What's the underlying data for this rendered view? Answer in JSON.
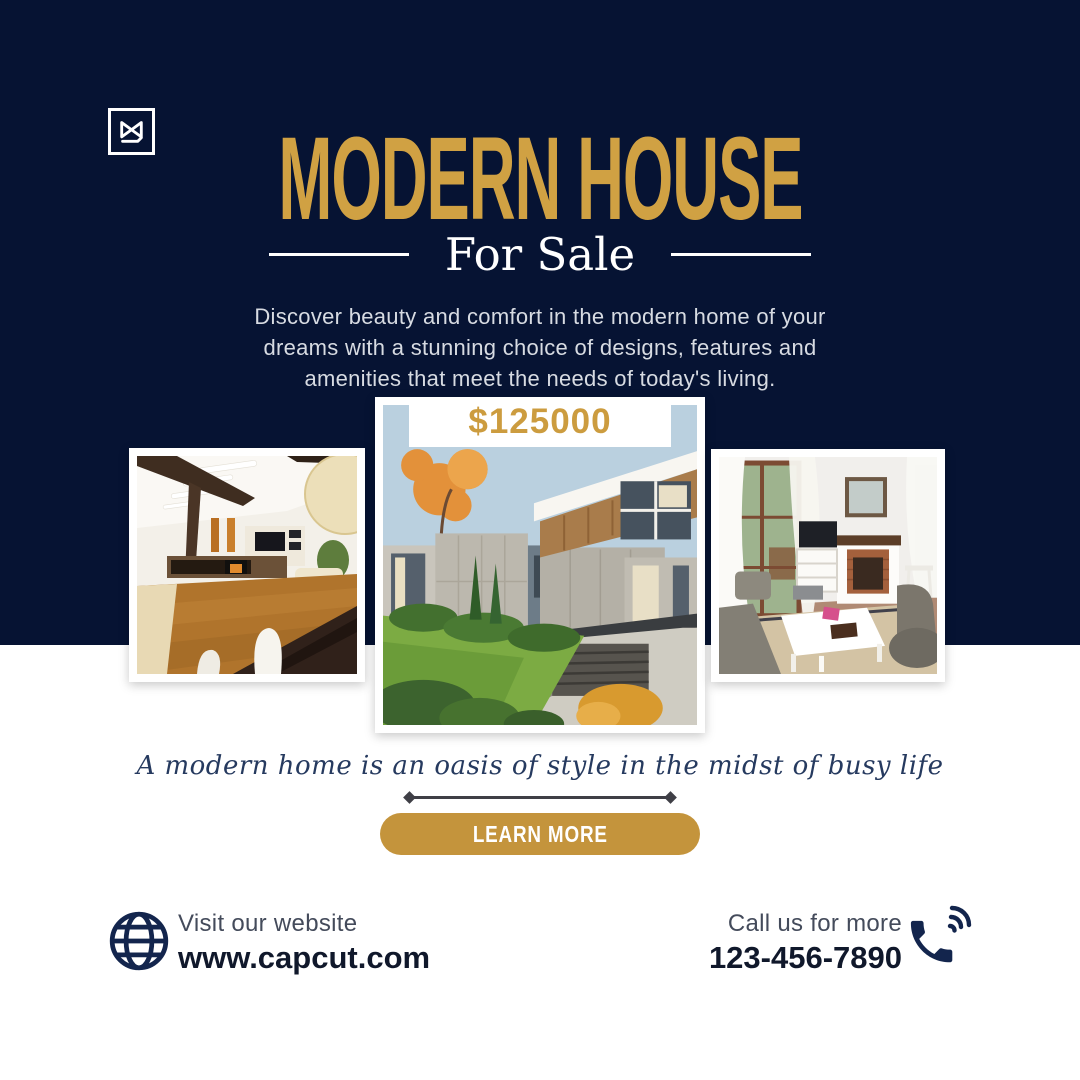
{
  "brand": {
    "logo_alt": "CapCut"
  },
  "header": {
    "title": "MODERN HOUSE",
    "subtitle": "For Sale"
  },
  "intro": {
    "text": "Discover beauty and comfort in the modern home of your dreams with a stunning choice of designs, features and amenities that meet the needs of today's living."
  },
  "listing": {
    "price": "$125000",
    "photos": [
      {
        "name": "living-room-interior"
      },
      {
        "name": "modern-house-exterior"
      },
      {
        "name": "cozy-lounge-interior"
      }
    ]
  },
  "quote": {
    "text": "A modern home is an oasis of style in the midst of busy life"
  },
  "cta": {
    "label": "LEARN MORE"
  },
  "footer": {
    "website_label": "Visit our website",
    "website_url": "www.capcut.com",
    "phone_label": "Call us for more",
    "phone_number": "123-456-7890"
  },
  "colors": {
    "navy_background": "#061333",
    "gold_title": "#D0A143",
    "gold_button": "#C4943C",
    "light_text": "#D7DBE2",
    "ink_text": "#10182B",
    "divider_gray": "#3F3F46"
  },
  "icons": {
    "logo": "capcut-icon",
    "globe": "globe-icon",
    "phone": "phone-icon"
  }
}
